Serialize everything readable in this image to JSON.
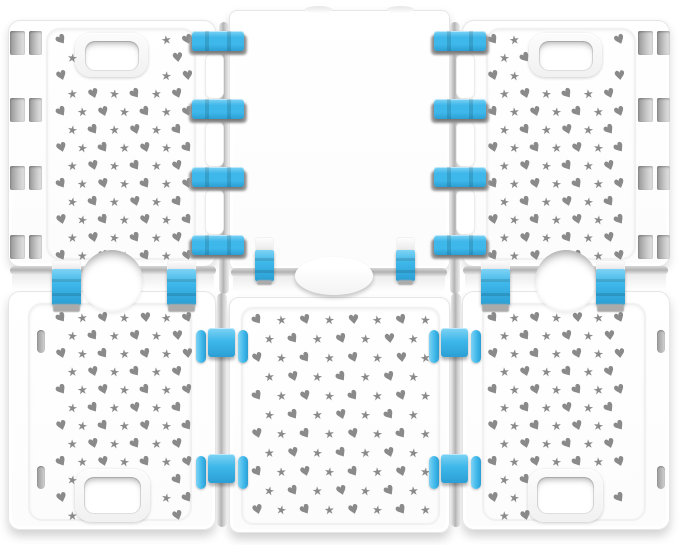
{
  "scene": {
    "type": "product-photo",
    "subject": "Adjustable clothes folding board made of six white plastic panels joined by bright blue hinge clips; four panels have handle cutouts and all but the top-center panel are perforated with small gray heart and star shaped holes",
    "background_color": "#ffffff",
    "panel_count": 6,
    "panels": [
      {
        "id": "top-left",
        "has_handle": true,
        "perforated": true
      },
      {
        "id": "top-center",
        "has_handle": false,
        "perforated": false
      },
      {
        "id": "top-right",
        "has_handle": true,
        "perforated": true
      },
      {
        "id": "bottom-left",
        "has_handle": true,
        "perforated": true
      },
      {
        "id": "bottom-center",
        "has_handle": false,
        "perforated": true
      },
      {
        "id": "bottom-right",
        "has_handle": true,
        "perforated": true
      }
    ]
  },
  "colors": {
    "panel_white": "#ffffff",
    "panel_border": "#e6e6e6",
    "perforation_gray": "#8a8a8a",
    "hinge_blue": "#3eb7ea",
    "hinge_blue_light": "#7ed3f4",
    "hinge_blue_dark": "#2b9fd4",
    "seam_gray": "#b2b2b2"
  },
  "pattern": {
    "heart_glyph": "♥",
    "star_glyph": "★",
    "heart_size": 13,
    "star_size": 12
  },
  "perforation_regions": [
    {
      "id": "top-left",
      "x": 56,
      "y": 34,
      "w": 136,
      "h": 224,
      "cw": 21,
      "ch": 18,
      "exclude": [
        {
          "x": 68,
          "y": 26,
          "w": 88,
          "h": 58
        }
      ]
    },
    {
      "id": "top-right",
      "x": 488,
      "y": 34,
      "w": 136,
      "h": 224,
      "cw": 21,
      "ch": 18,
      "exclude": [
        {
          "x": 520,
          "y": 26,
          "w": 92,
          "h": 58
        }
      ]
    },
    {
      "id": "bottom-left",
      "x": 56,
      "y": 312,
      "w": 136,
      "h": 204,
      "cw": 21,
      "ch": 18,
      "exclude": [
        {
          "x": 68,
          "y": 460,
          "w": 90,
          "h": 64
        }
      ]
    },
    {
      "id": "bottom-right",
      "x": 488,
      "y": 312,
      "w": 136,
      "h": 204,
      "cw": 21,
      "ch": 18,
      "exclude": [
        {
          "x": 520,
          "y": 460,
          "w": 92,
          "h": 64
        }
      ]
    },
    {
      "id": "bottom-center",
      "x": 252,
      "y": 314,
      "w": 178,
      "h": 202,
      "cw": 24,
      "ch": 19,
      "exclude": []
    }
  ],
  "clips": {
    "horizontal_bars": [
      {
        "x": 192,
        "y": 31
      },
      {
        "x": 192,
        "y": 99
      },
      {
        "x": 192,
        "y": 167
      },
      {
        "x": 192,
        "y": 235
      },
      {
        "x": 434,
        "y": 31
      },
      {
        "x": 434,
        "y": 99
      },
      {
        "x": 434,
        "y": 167
      },
      {
        "x": 434,
        "y": 235
      }
    ],
    "center_vertical": [
      {
        "x": 255,
        "y": 237
      },
      {
        "x": 396,
        "y": 237
      }
    ],
    "side_vertical": [
      {
        "x": 52,
        "y": 260
      },
      {
        "x": 167,
        "y": 260
      },
      {
        "x": 481,
        "y": 260
      },
      {
        "x": 596,
        "y": 260
      }
    ],
    "bottom_assemblies": [
      {
        "cx": 222,
        "y": 328
      },
      {
        "cx": 222,
        "y": 454
      },
      {
        "cx": 455,
        "y": 328
      },
      {
        "cx": 455,
        "y": 454
      }
    ]
  },
  "slots": {
    "top_edge_pairs": [
      {
        "x": 10,
        "y": 31
      },
      {
        "x": 10,
        "y": 98
      },
      {
        "x": 10,
        "y": 166
      },
      {
        "x": 10,
        "y": 235
      },
      {
        "x": 638,
        "y": 31
      },
      {
        "x": 638,
        "y": 98
      },
      {
        "x": 638,
        "y": 166
      },
      {
        "x": 638,
        "y": 235
      }
    ],
    "bottom_edge": [
      {
        "x": 37,
        "y": 330
      },
      {
        "x": 37,
        "y": 466
      },
      {
        "x": 657,
        "y": 330
      },
      {
        "x": 657,
        "y": 466
      }
    ]
  },
  "tabs": [
    {
      "x": 205,
      "y": 53
    },
    {
      "x": 205,
      "y": 121
    },
    {
      "x": 205,
      "y": 189
    },
    {
      "x": 456,
      "y": 53
    },
    {
      "x": 456,
      "y": 121
    },
    {
      "x": 456,
      "y": 189
    }
  ]
}
